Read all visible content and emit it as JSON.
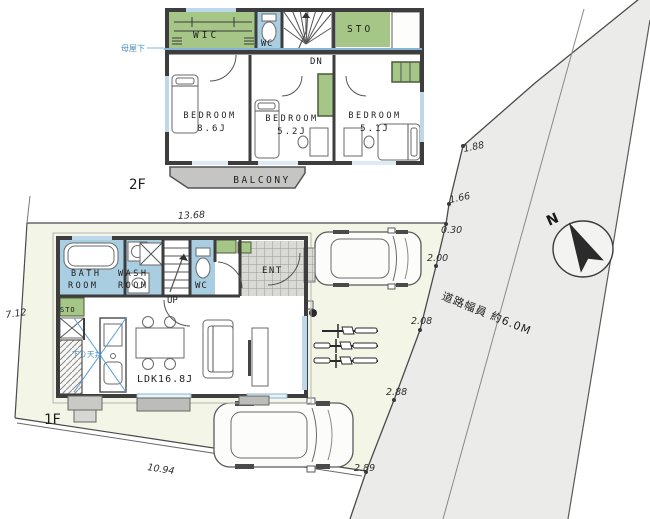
{
  "floor2": {
    "label": "2F",
    "wic": "WIC",
    "wc": "WC",
    "sto": "STO",
    "dn": "DN",
    "moya_note": "母屋下",
    "bedroom1_name": "BEDROOM",
    "bedroom1_size": "8.6J",
    "bedroom2_name": "BEDROOM",
    "bedroom2_size": "5.2J",
    "bedroom3_name": "BEDROOM",
    "bedroom3_size": "5.1J",
    "balcony": "BALCONY"
  },
  "floor1": {
    "label": "1F",
    "bath_l1": "BATH",
    "bath_l2": "ROOM",
    "wash_l1": "WASH",
    "wash_l2": "ROOM",
    "up": "UP",
    "wc": "WC",
    "ent": "ENT",
    "sto": "STO",
    "ldk": "LDK16.8J",
    "kitchen_note": "下り天井"
  },
  "site": {
    "dim_top": "13.68",
    "dim_left": "7.12",
    "dim_bottom": "10.94",
    "boundary_dims": [
      "1.88",
      "1.66",
      "0.30",
      "2.00",
      "2.08",
      "2.88",
      "2.89"
    ],
    "road_label": "道路幅員 約6.0M",
    "north": "N"
  },
  "colors": {
    "room_green": "#a5c687",
    "room_blue": "#a9cde1",
    "wall": "#3d3d3d",
    "balcony_gray": "#c5c5c3",
    "site_fill": "#f3f6e7",
    "road_fill": "#ebebe9",
    "annotation_blue": "#4a90c4",
    "window_blue": "#bcd8ea"
  }
}
